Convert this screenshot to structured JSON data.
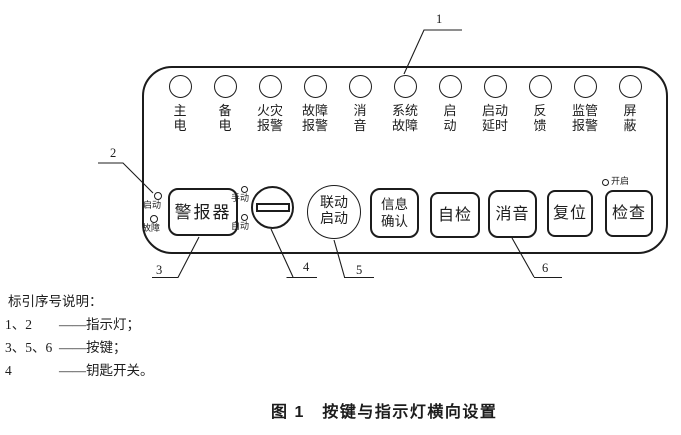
{
  "panel": {
    "indicators": [
      {
        "line1": "主",
        "line2": "电"
      },
      {
        "line1": "备",
        "line2": "电"
      },
      {
        "line1": "火灾",
        "line2": "报警"
      },
      {
        "line1": "故障",
        "line2": "报警"
      },
      {
        "line1": "消",
        "line2": "音"
      },
      {
        "line1": "系统",
        "line2": "故障"
      },
      {
        "line1": "启",
        "line2": "动"
      },
      {
        "line1": "启动",
        "line2": "延时"
      },
      {
        "line1": "反",
        "line2": "馈"
      },
      {
        "line1": "监管",
        "line2": "报警"
      },
      {
        "line1": "屏",
        "line2": "蔽"
      }
    ],
    "alarm_device": {
      "button_label": "警报器",
      "start_light_label": "启动",
      "fault_light_label": "故障"
    },
    "key_switch": {
      "manual_label": "手动",
      "auto_label": "自动"
    },
    "linkage_start": {
      "line1": "联动",
      "line2": "启动"
    },
    "info_confirm": {
      "line1": "信息",
      "line2": "确认"
    },
    "self_test_label": "自检",
    "mute_label": "消音",
    "reset_label": "复位",
    "check_label": "检查",
    "check_light_label": "开启"
  },
  "callouts": {
    "c1": "1",
    "c2": "2",
    "c3": "3",
    "c4": "4",
    "c5": "5",
    "c6": "6"
  },
  "legend": {
    "title": "标引序号说明：",
    "items": [
      {
        "num": "1、2",
        "desc": "——指示灯；"
      },
      {
        "num": "3、5、6",
        "desc": "——按键；"
      },
      {
        "num": "4",
        "desc": "——钥匙开关。"
      }
    ]
  },
  "caption": "图 1　按键与指示灯横向设置",
  "colors": {
    "ink": "#1c1c1c",
    "background": "#ffffff"
  }
}
